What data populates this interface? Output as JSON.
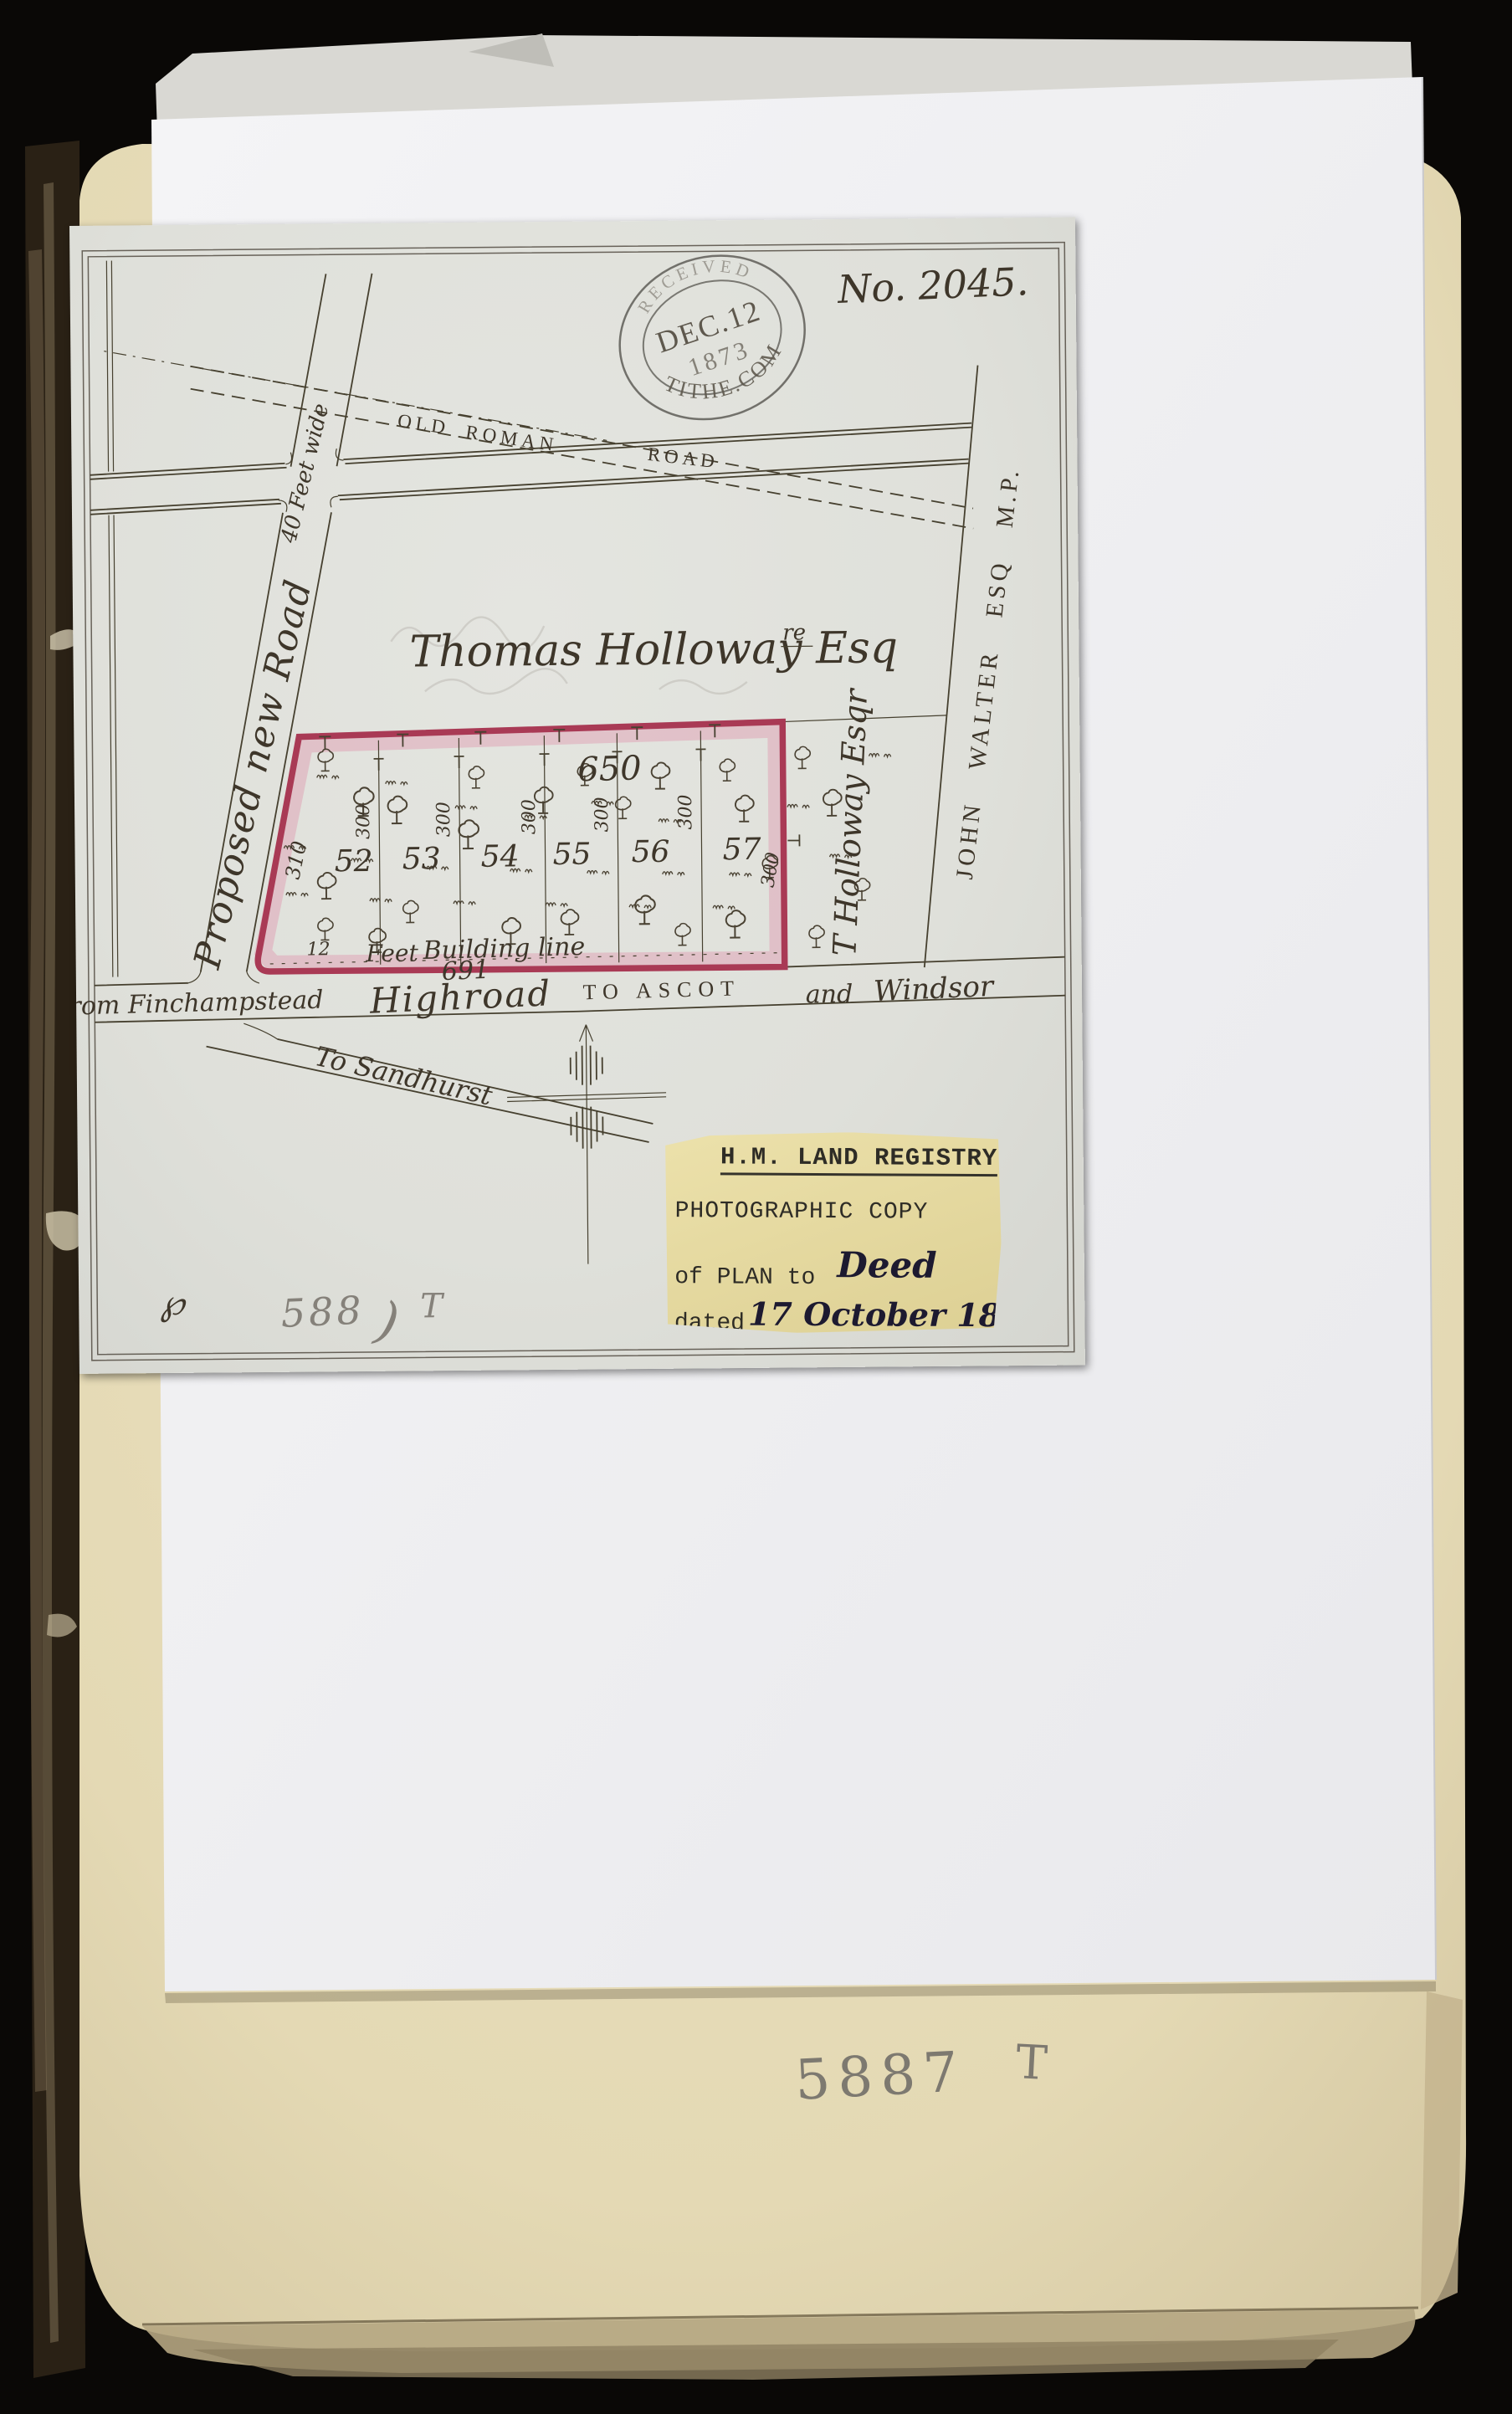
{
  "photo": {
    "stamp": {
      "received": "RECEIVED",
      "date": "DEC.12",
      "year": "1873",
      "office": "TITHE.COM"
    },
    "plan_no": "No. 2045.",
    "names": {
      "owner": "Thomas Holloway Esq",
      "owner_sup": "re",
      "parcel": "T Holloway Esqr",
      "neighbor": "JOHN WALTER ESQ M.P."
    },
    "roads": {
      "old": "OLD",
      "roman": "ROMAN",
      "road": "ROAD",
      "proposed": "Proposed new Road",
      "width": "40 Feet wide",
      "from": "from Finchampstead",
      "highroad": "Highroad",
      "to": "TO ASCOT",
      "and": "and",
      "windsor": "Windsor",
      "sandhurst": "To Sandhurst"
    },
    "plot": {
      "numbers": [
        "52",
        "53",
        "54",
        "55",
        "56",
        "57"
      ],
      "front": "650",
      "rear": "691",
      "left": "310",
      "depth": "300",
      "setback": "12",
      "feet": "Feet",
      "building": "Building line"
    },
    "label": {
      "title": "H.M. LAND REGISTRY",
      "line2": "PHOTOGRAPHIC COPY",
      "line3": "of PLAN to",
      "line3_hand": "Deed",
      "line4": "dated",
      "line4_hand": "17 October 1873."
    },
    "pencil": {
      "ref_num": "588",
      "ref_paren": ")",
      "ref_t": "T",
      "page_num": "5887",
      "page_t": "T"
    },
    "ink_mark": "℘"
  },
  "colors": {
    "plot_outline": "#a93a55",
    "plot_wash": "#dfa0b4",
    "label_bg": "#e7dda6",
    "ink": "#3e362a",
    "pencil": "#8a867e",
    "map_paper": "#e0e1dc",
    "book_page": "#e6dcba",
    "white_sheet": "#f2f2f5",
    "background": "#0a0806"
  }
}
